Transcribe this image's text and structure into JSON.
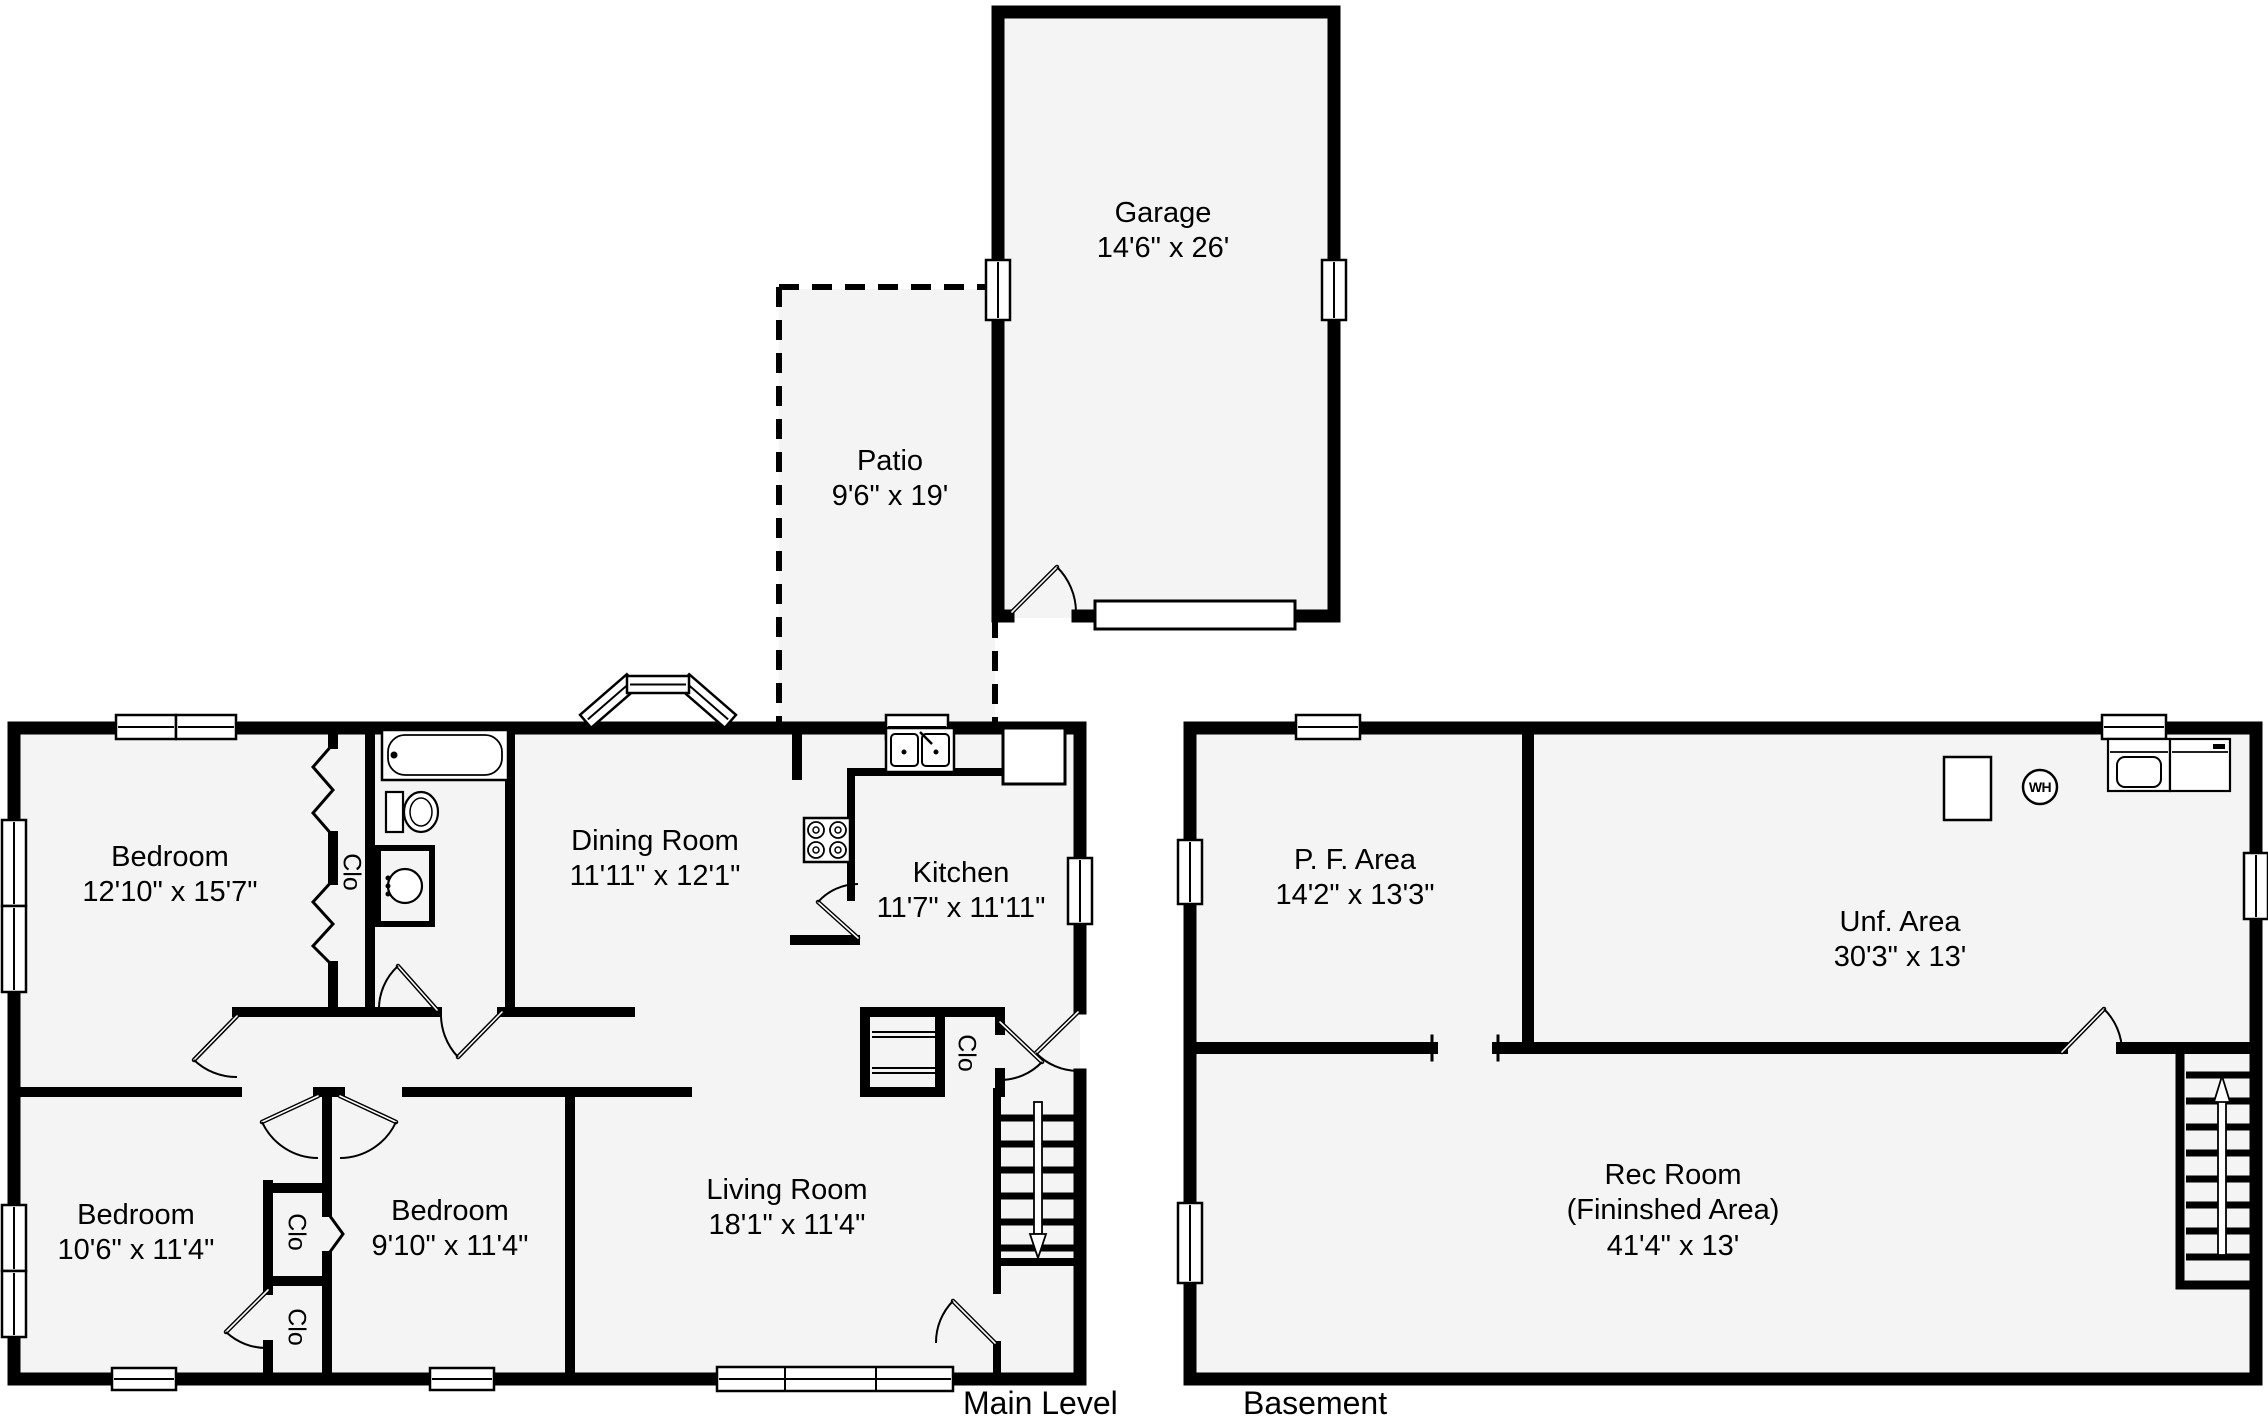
{
  "plan": {
    "levels": {
      "main": "Main Level",
      "basement": "Basement"
    },
    "rooms": {
      "garage": {
        "name": "Garage",
        "dims": "14'6\" x 26'"
      },
      "patio": {
        "name": "Patio",
        "dims": "9'6\" x 19'"
      },
      "bedroom1": {
        "name": "Bedroom",
        "dims": "12'10\" x 15'7\""
      },
      "dining": {
        "name": "Dining Room",
        "dims": "11'11\" x 12'1\""
      },
      "kitchen": {
        "name": "Kitchen",
        "dims": "11'7\" x 11'11\""
      },
      "bedroom2": {
        "name": "Bedroom",
        "dims": "10'6\" x 11'4\""
      },
      "bedroom3": {
        "name": "Bedroom",
        "dims": "9'10\" x 11'4\""
      },
      "living": {
        "name": "Living Room",
        "dims": "18'1\" x 11'4\""
      },
      "pf_area": {
        "name": "P. F. Area",
        "dims": "14'2\" x 13'3\""
      },
      "unf_area": {
        "name": "Unf. Area",
        "dims": "30'3\" x 13'"
      },
      "rec_room": {
        "name": "Rec Room",
        "sub": "(Fininshed Area)",
        "dims": "41'4\" x 13'"
      }
    },
    "labels": {
      "closet": "Clo",
      "water_heater": "WH"
    },
    "colors": {
      "wall": "#000000",
      "floor": "#f4f4f4",
      "background": "#ffffff"
    }
  }
}
